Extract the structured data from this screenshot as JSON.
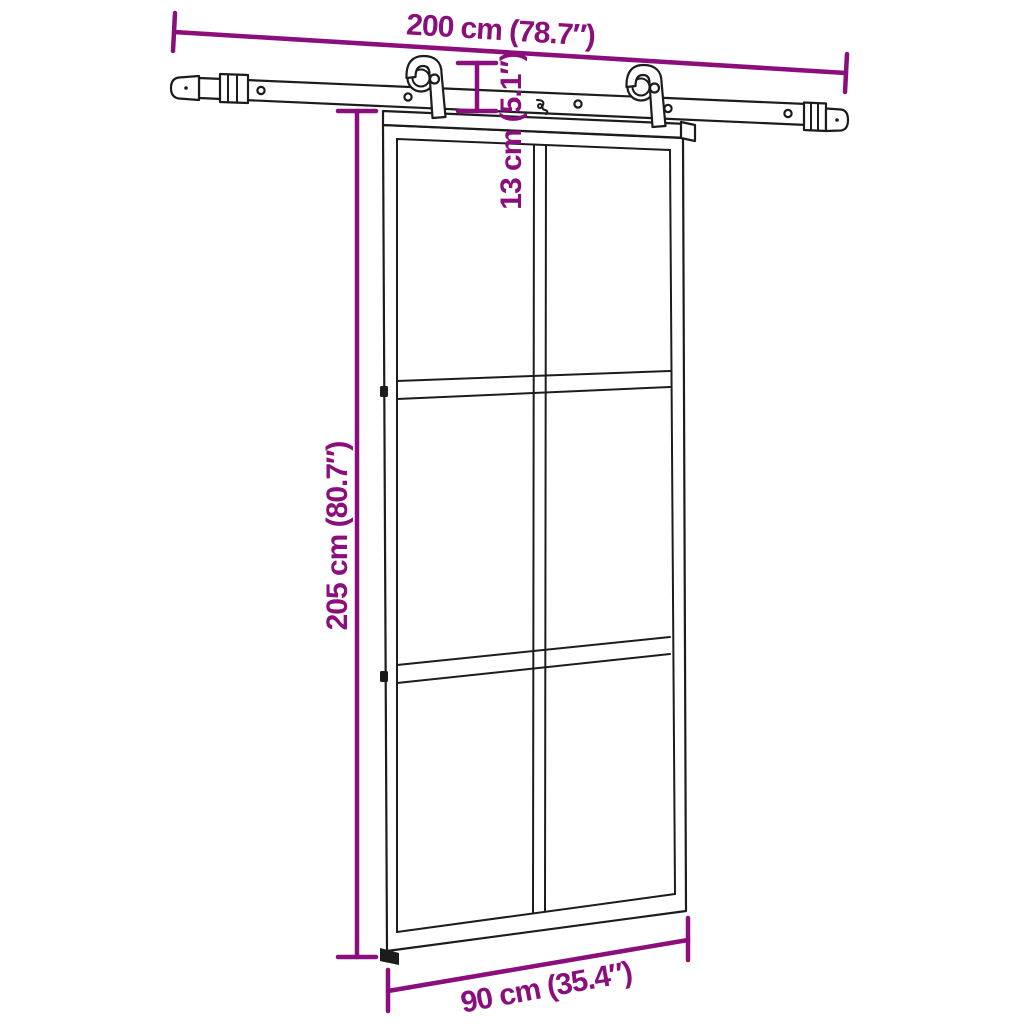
{
  "diagram": {
    "type": "product-dimension-diagram",
    "subject": "sliding-glass-door-with-rail-hardware",
    "background_color": "#ffffff",
    "line_color": "#1c1c1c",
    "dimension_color": "#8a0e7b",
    "dimensions": {
      "rail_width": {
        "label": "200 cm (78.7″)",
        "value_cm": 200,
        "value_inch": 78.7
      },
      "hanger_drop": {
        "label": "13 cm (5.1″)",
        "value_cm": 13,
        "value_inch": 5.1
      },
      "door_height": {
        "label": "205 cm (80.7″)",
        "value_cm": 205,
        "value_inch": 80.7
      },
      "door_width": {
        "label": "90 cm (35.4″)",
        "value_cm": 90,
        "value_inch": 35.4
      }
    }
  }
}
